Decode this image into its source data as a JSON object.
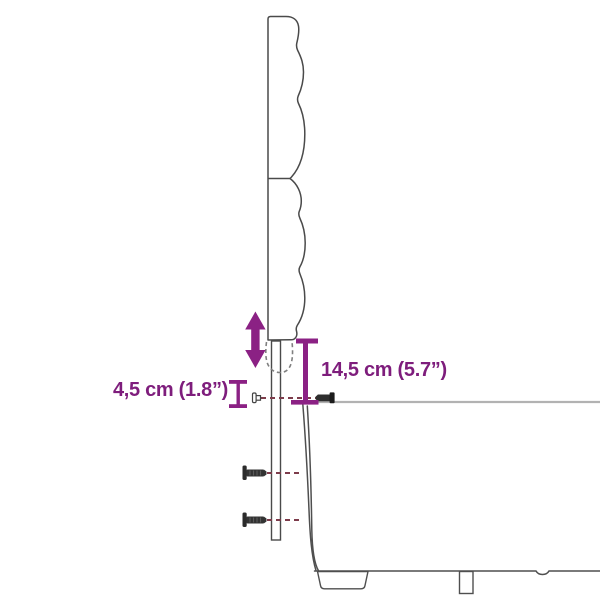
{
  "diagram": {
    "kind": "furniture-dimension-diagram",
    "subject": "bed side profile with height-adjustable headboard",
    "background": "#ffffff"
  },
  "measurements": {
    "adjustment_range": {
      "label": "4,5 cm (1.8”)",
      "value_cm": "4,5",
      "value_in": "1.8"
    },
    "mounting_drop": {
      "label": "14,5 cm (5.7”)",
      "value_cm": "14,5",
      "value_in": "5.7"
    }
  },
  "colors": {
    "accent_purple": "#8b2184",
    "label_purple": "#7e1d7c",
    "outline_gray": "#4f4f4f",
    "dash_maroon": "#7d3c4b",
    "rail_gray": "#b2b2b2",
    "background": "#ffffff"
  },
  "icons": {
    "adjustment": "up-down-arrow-icon",
    "fasteners": [
      "screw-icon",
      "screw-icon",
      "bolt-side-icon",
      "pin-icon"
    ]
  }
}
